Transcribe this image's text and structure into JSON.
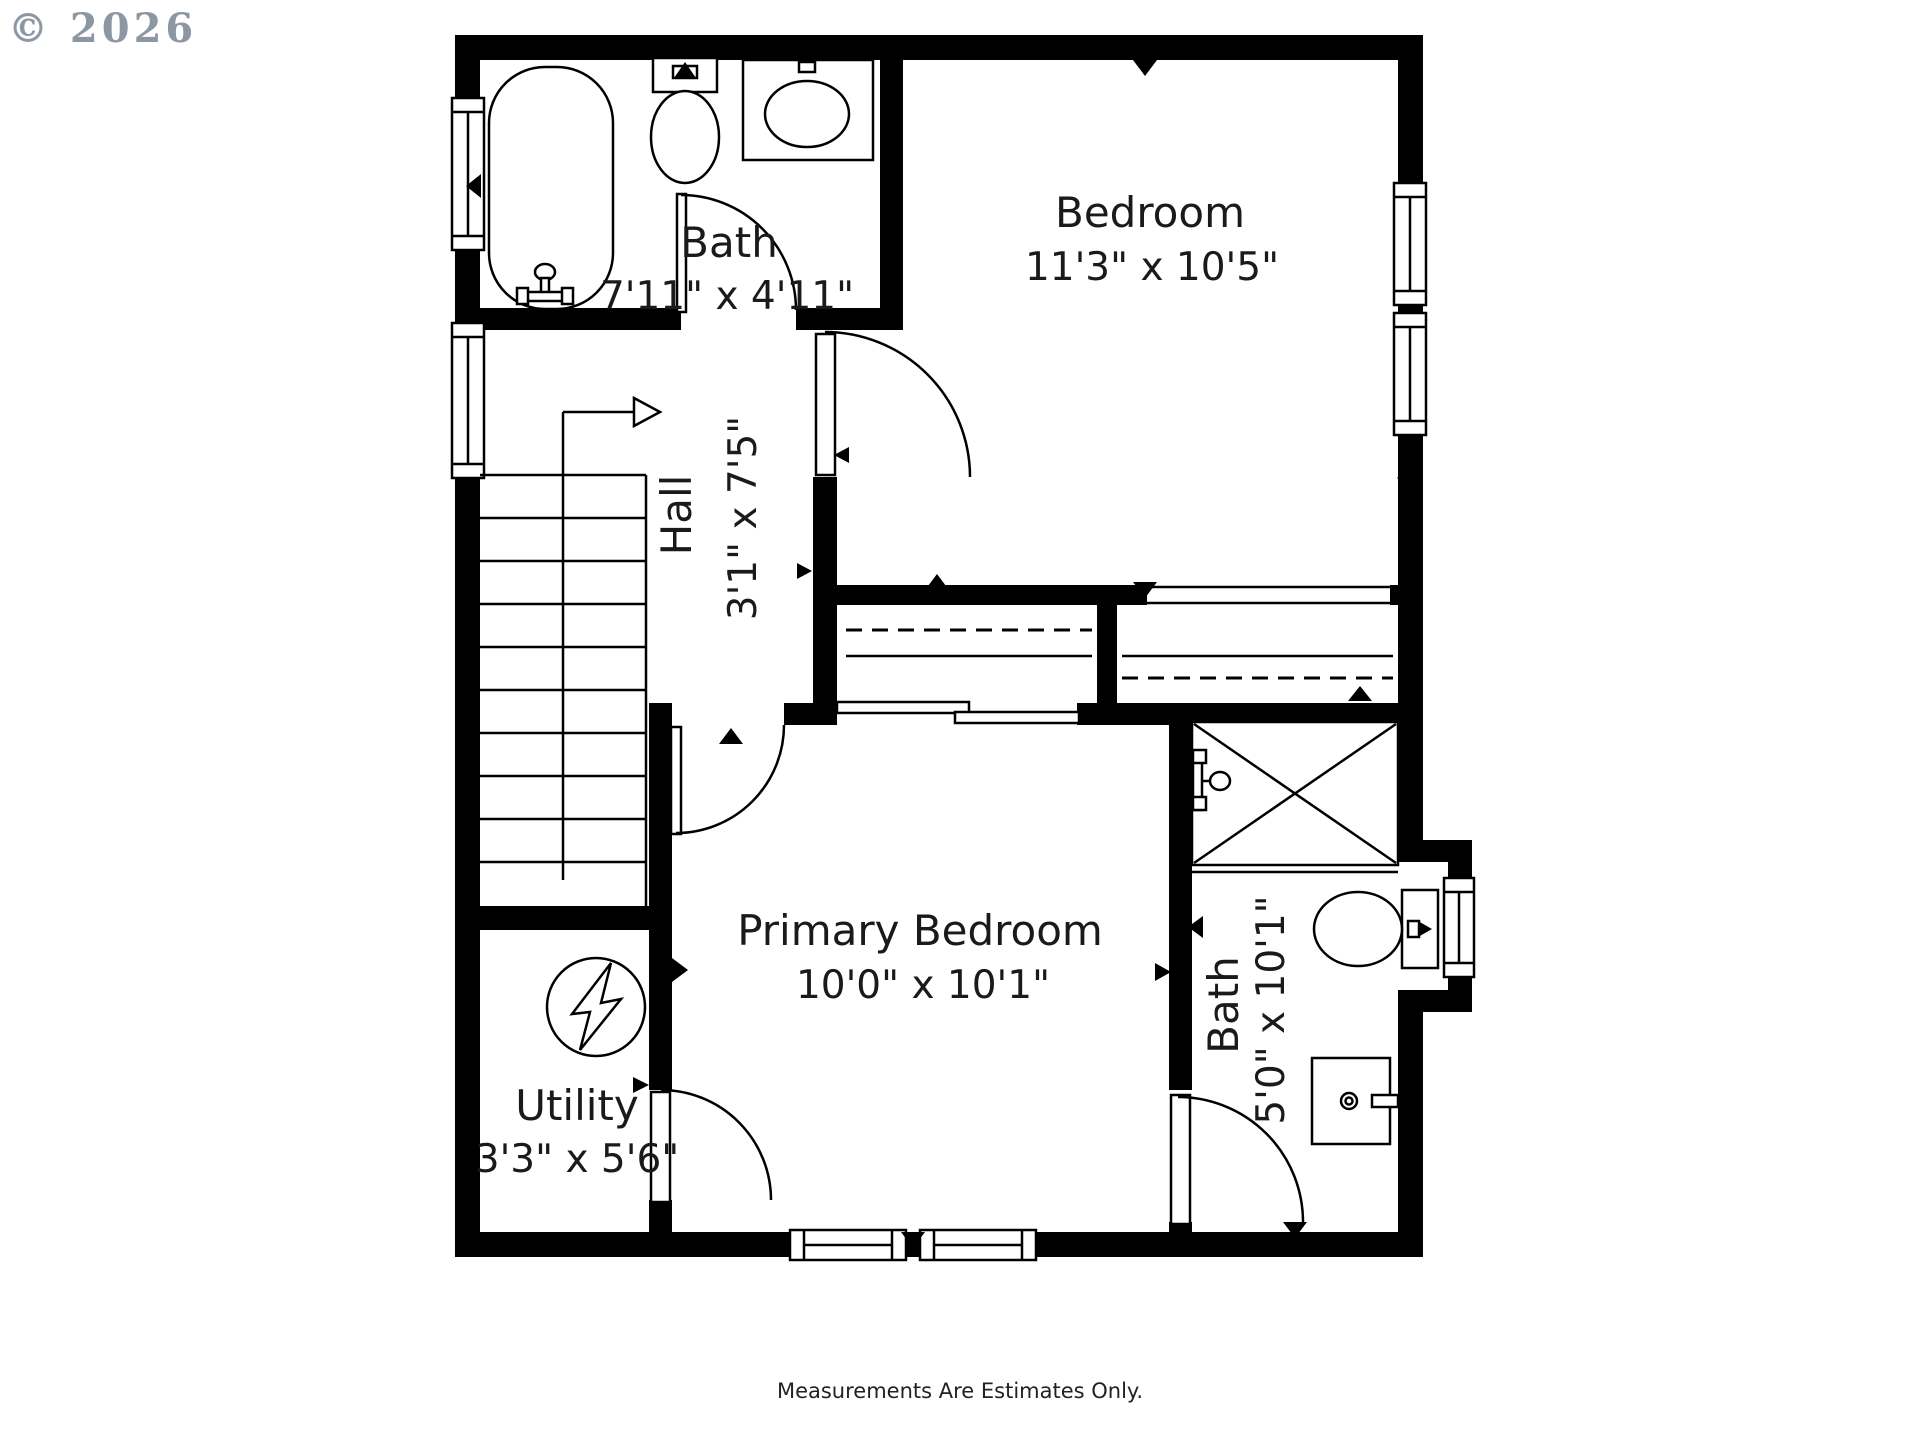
{
  "copyright": "© 2026",
  "footer": "Measurements Are Estimates Only.",
  "rooms": {
    "bath1": {
      "name": "Bath",
      "dims": "7'11\" x 4'11\""
    },
    "bedroom": {
      "name": "Bedroom",
      "dims": "11'3\" x 10'5\""
    },
    "hall": {
      "name": "Hall",
      "dims": "3'1\" x 7'5\""
    },
    "primary": {
      "name": "Primary Bedroom",
      "dims": "10'0\" x 10'1\""
    },
    "utility": {
      "name": "Utility",
      "dims": "3'3\" x 5'6\""
    },
    "bath2": {
      "name": "Bath",
      "dims": "5'0\" x 10'1\""
    }
  },
  "icons": [
    "bathtub",
    "toilet",
    "vanity-sink",
    "shower",
    "water-heater",
    "stairs",
    "window",
    "door-swing",
    "sliding-closet-door",
    "closet-rod-dashed",
    "direction-arrow"
  ],
  "colors": {
    "wall": "#000000",
    "background": "#ffffff",
    "copyright_gray": "#8d97a3",
    "text": "#1a1a1a"
  }
}
